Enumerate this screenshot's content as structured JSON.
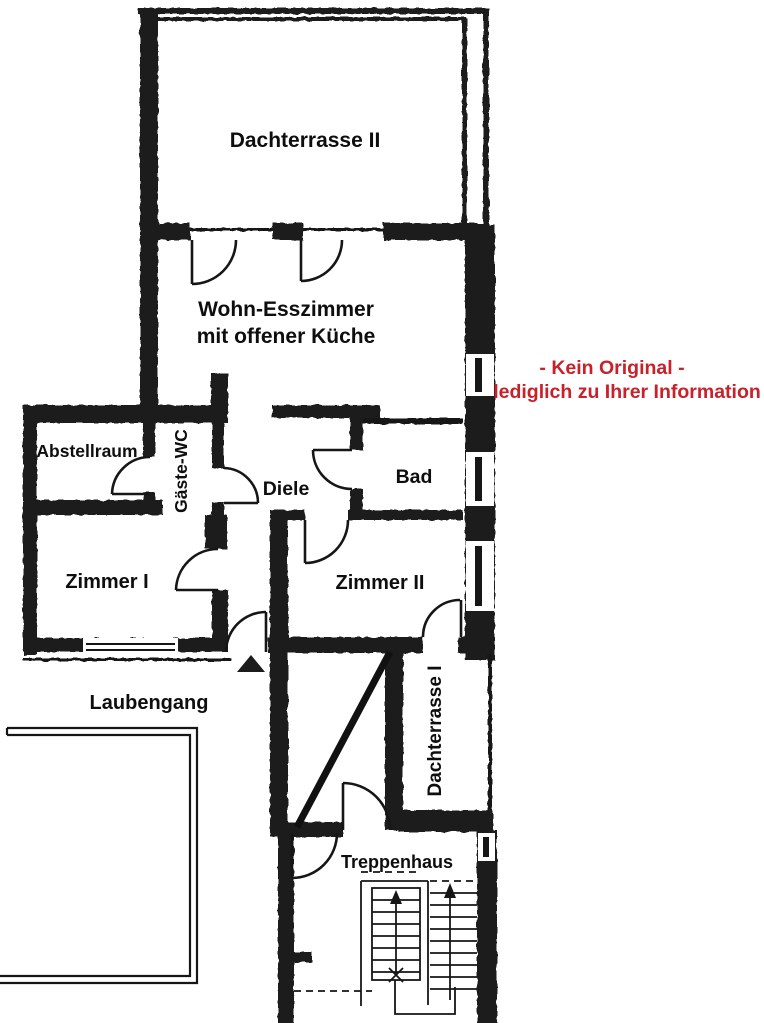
{
  "rooms": {
    "dachterrasse2": {
      "label": "Dachterrasse II"
    },
    "wohnEsszimmer": {
      "line1": "Wohn-Esszimmer",
      "line2": "mit offener Küche"
    },
    "abstellraum": {
      "label": "Abstellraum"
    },
    "gaesteWc": {
      "label": "Gäste-WC"
    },
    "diele": {
      "label": "Diele"
    },
    "bad": {
      "label": "Bad"
    },
    "zimmer1": {
      "label": "Zimmer I"
    },
    "zimmer2": {
      "label": "Zimmer II"
    },
    "laubengang": {
      "label": "Laubengang"
    },
    "dachterrasse1": {
      "label": "Dachterrasse I"
    },
    "treppenhaus": {
      "label": "Treppenhaus"
    }
  },
  "disclaimer": {
    "line1": "- Kein Original -",
    "line2": "lediglich zu Ihrer Information",
    "color": "#c9202a"
  },
  "colors": {
    "wall": "#1c1c1c",
    "line": "#161616",
    "background": "#ffffff"
  }
}
